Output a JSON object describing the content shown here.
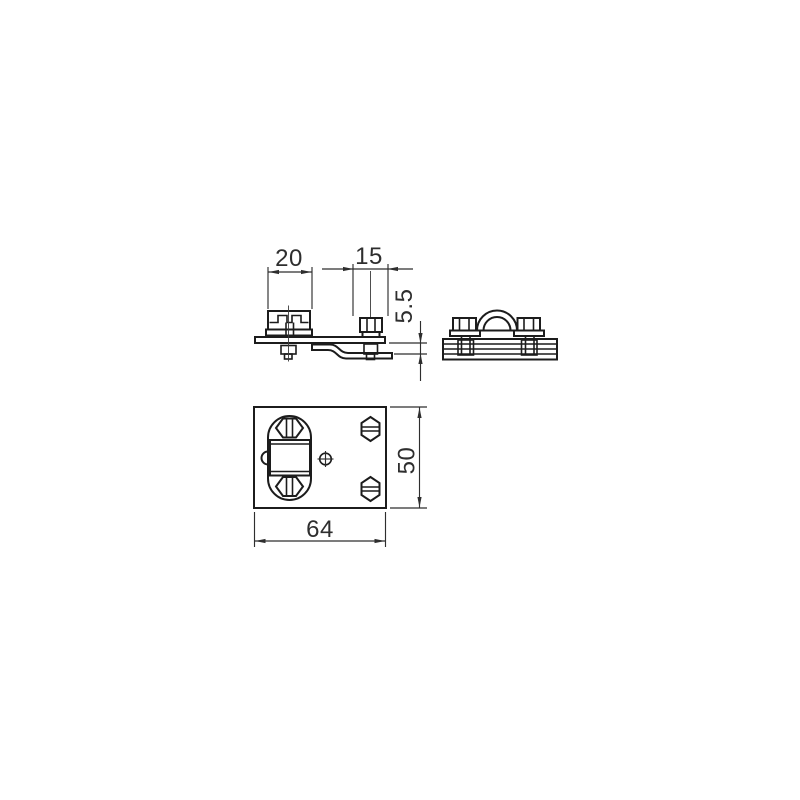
{
  "page": {
    "background": "#ffffff"
  },
  "drawing": {
    "type": "technical-orthographic-views",
    "object_line_color": "#1c1c1c",
    "dimension_line_color": "#2e2e2e",
    "views": {
      "side_view": "side-elevation-with-clamp-and-z-bracket",
      "front_view": "front-elevation-with-saddle-clamp-and-two-bolts",
      "top_view": "plan-view-of-base-plate"
    },
    "dimensions": {
      "clamp_width": "20",
      "bracket_offset": "15",
      "step_height": "5.5",
      "plate_depth": "50",
      "plate_width": "64"
    }
  }
}
